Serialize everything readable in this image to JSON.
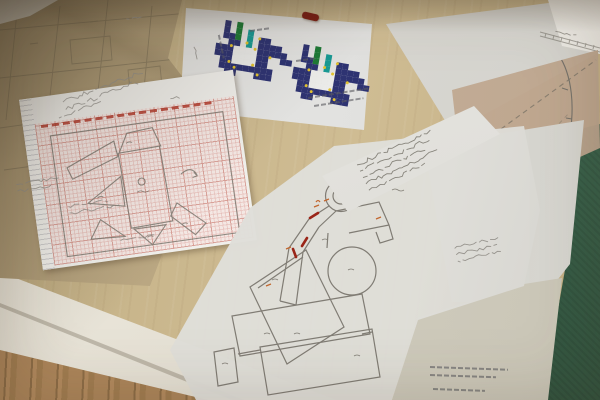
{
  "scene": {
    "subject": "work table photographed from above with overlapping pattern drafts, graph-paper sketch, pixel-pattern printout and tracing-paper drawings",
    "colors": {
      "table_wood": "#c9b68c",
      "floor_wood": "#a8855c",
      "table_edge": "#ebe7db",
      "green_mat": "#3e6951",
      "kraft_paper": "#bfab85",
      "white_sheet": "#e9e9e7",
      "tracing_paper": "#dcdbd6",
      "tan_pattern_piece": "#c9b29b",
      "beige_sheet": "#d6d1c3",
      "graph_grid_bg": "#f4e8e4",
      "graph_grid_line": "#d59890",
      "graph_red_print": "#b43a2c",
      "pencil": "#84807a",
      "pencil_dark": "#6e6a62",
      "red_annotation": "#9a2518",
      "orange_annotation": "#c2672f",
      "red_pen_cap": "#7e1c12",
      "pixel_navy": "#2e3372",
      "pixel_green": "#1e7a36",
      "pixel_teal": "#199a94",
      "pixel_yellow": "#e2c22f"
    }
  },
  "pixel_patterns": {
    "cell_px": 6,
    "palette": {
      "N": "#2e3372",
      "G": "#1e7a36",
      "T": "#199a94",
      "W": "#ebebe9"
    },
    "grid": [
      "..N.G.........",
      "..N.G.T.......",
      "..NNG.T.NN....",
      "...NN.T.NNNN..",
      ".NNNWWWWNNNNN.",
      ".NNNWWWWNN..NN",
      "..NNWWWWNN....",
      "..NNNNNNNNN...",
      "...NN...NNN..."
    ],
    "yellow_dots": [
      [
        4.0,
        3.6
      ],
      [
        4.0,
        7.6
      ],
      [
        6.8,
        3.6
      ],
      [
        6.8,
        7.6
      ],
      [
        2.3,
        8.1
      ],
      [
        5.1,
        10.3
      ],
      [
        7.6,
        4.6
      ],
      [
        3.3,
        6.1
      ],
      [
        8.2,
        8.6
      ]
    ],
    "instances": [
      {
        "x": 214,
        "y": 18,
        "rot": 9
      },
      {
        "x": 292,
        "y": 42,
        "rot": 10
      }
    ]
  },
  "handwriting_blocks": [
    {
      "x": 60,
      "y": 100,
      "w": 86,
      "rows": 2,
      "gap": 8,
      "rot": -21,
      "color": "pencil",
      "amp": 2.2
    },
    {
      "x": 56,
      "y": 116,
      "w": 44,
      "rows": 1,
      "gap": 8,
      "rot": -21,
      "color": "pencil",
      "amp": 2.0
    },
    {
      "x": 354,
      "y": 163,
      "w": 80,
      "rows": 5,
      "gap": 7,
      "rot": -25,
      "color": "pencil_dark",
      "amp": 2.0
    },
    {
      "x": 452,
      "y": 246,
      "w": 44,
      "rows": 3,
      "gap": 6.5,
      "rot": -14,
      "color": "pencil",
      "amp": 1.8
    },
    {
      "x": 14,
      "y": 182,
      "w": 42,
      "rows": 2,
      "gap": 6.5,
      "rot": -9,
      "color": "pencil",
      "amp": 1.7
    },
    {
      "x": 66,
      "y": 204,
      "w": 54,
      "rows": 2,
      "gap": 6.5,
      "rot": -9,
      "color": "pencil",
      "amp": 1.7
    },
    {
      "x": 118,
      "y": 238,
      "w": 46,
      "rows": 1,
      "gap": 6.5,
      "rot": -9,
      "color": "pencil",
      "amp": 1.7
    },
    {
      "x": 554,
      "y": 28,
      "w": 28,
      "rows": 1,
      "gap": 6,
      "rot": 11,
      "color": "pencil",
      "amp": 1.5
    },
    {
      "x": 124,
      "y": 16,
      "w": 20,
      "rows": 1,
      "gap": 5,
      "rot": -6,
      "color": "pencil",
      "amp": 1.3
    },
    {
      "x": 196,
      "y": 44,
      "w": 16,
      "rows": 1,
      "gap": 5,
      "rot": 70,
      "color": "pencil",
      "amp": 1.3
    },
    {
      "x": 168,
      "y": 96,
      "w": 14,
      "rows": 1,
      "gap": 5,
      "rot": -8,
      "color": "pencil",
      "amp": 1.3
    }
  ],
  "microtext_bars": [
    {
      "x": 219,
      "y": 34,
      "w": 24,
      "rot": 78
    },
    {
      "x": 250,
      "y": 30,
      "w": 20,
      "rot": -8
    },
    {
      "x": 296,
      "y": 60,
      "w": 20,
      "rot": -8
    },
    {
      "x": 308,
      "y": 97,
      "w": 62,
      "rot": -9
    },
    {
      "x": 314,
      "y": 105,
      "w": 50,
      "rot": -9
    },
    {
      "x": 430,
      "y": 366,
      "w": 78,
      "rot": 2
    },
    {
      "x": 430,
      "y": 374,
      "w": 66,
      "rot": 2
    },
    {
      "x": 433,
      "y": 388,
      "w": 52,
      "rot": 2
    }
  ]
}
